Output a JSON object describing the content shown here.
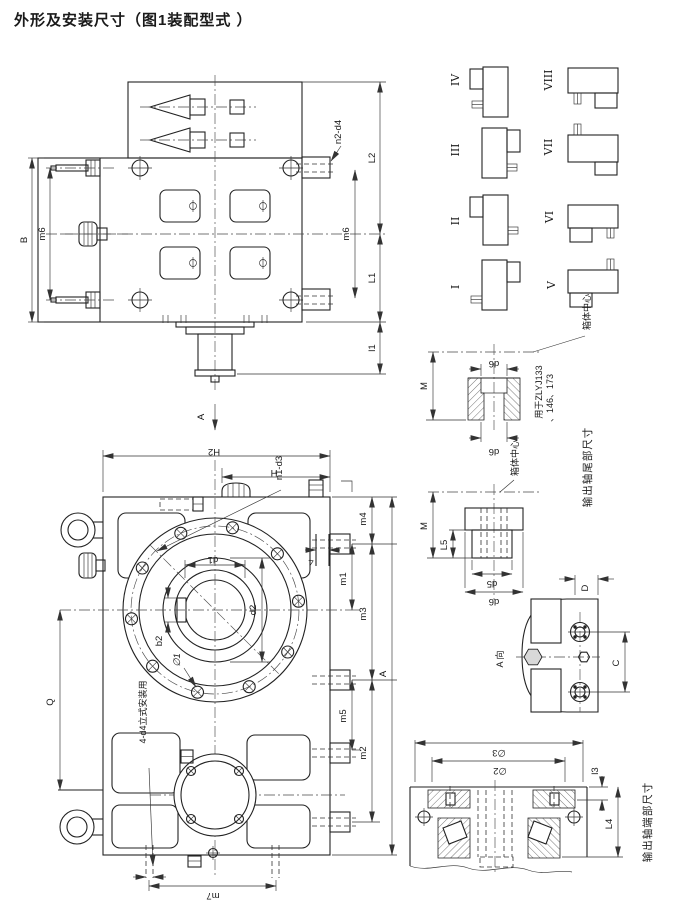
{
  "title": "外形及安装尺寸（图1装配型式 ）",
  "plan_view": {
    "B": "B",
    "m6_left": "m6",
    "n2_d4": "n2-d4",
    "L2": "L2",
    "m6_right": "m6",
    "L1": "L1",
    "l1": "l1",
    "view_arrow": "A"
  },
  "front_view": {
    "H2": "H2",
    "H": "H",
    "n1_d3": "n1-d3",
    "d1": "d1",
    "d2": "d2",
    "b2": "b2",
    "phi1": "∅1",
    "m4": "m4",
    "step": "4",
    "m1": "m1",
    "m3": "m3",
    "m5": "m5",
    "m2": "m2",
    "A": "A",
    "Q": "Q",
    "vertical_mount_note": "4-d4立式安装用",
    "m7": "m7"
  },
  "assembly_types": {
    "labels": [
      "I",
      "II",
      "III",
      "IV",
      "V",
      "VI",
      "VII",
      "VIII"
    ]
  },
  "tail_detail_upper": {
    "M": "M",
    "d6_top": "d6",
    "d6_bottom": "d6",
    "note_line1": "用于ZLYJ133",
    "note_line2": "、146、173",
    "box_center": "箱体中心"
  },
  "tail_detail_lower": {
    "M": "M",
    "L5": "L5",
    "d5": "d5",
    "d6": "d6",
    "box_center": "箱体中心"
  },
  "tail_caption": "输出轴尾部尺寸",
  "view_a": {
    "label": "A 向",
    "C": "C",
    "D": "D"
  },
  "section_view": {
    "phi3": "∅3",
    "phi2": "∅2",
    "l3": "l3",
    "L4": "L4",
    "caption": "输出轴端部尺寸"
  }
}
